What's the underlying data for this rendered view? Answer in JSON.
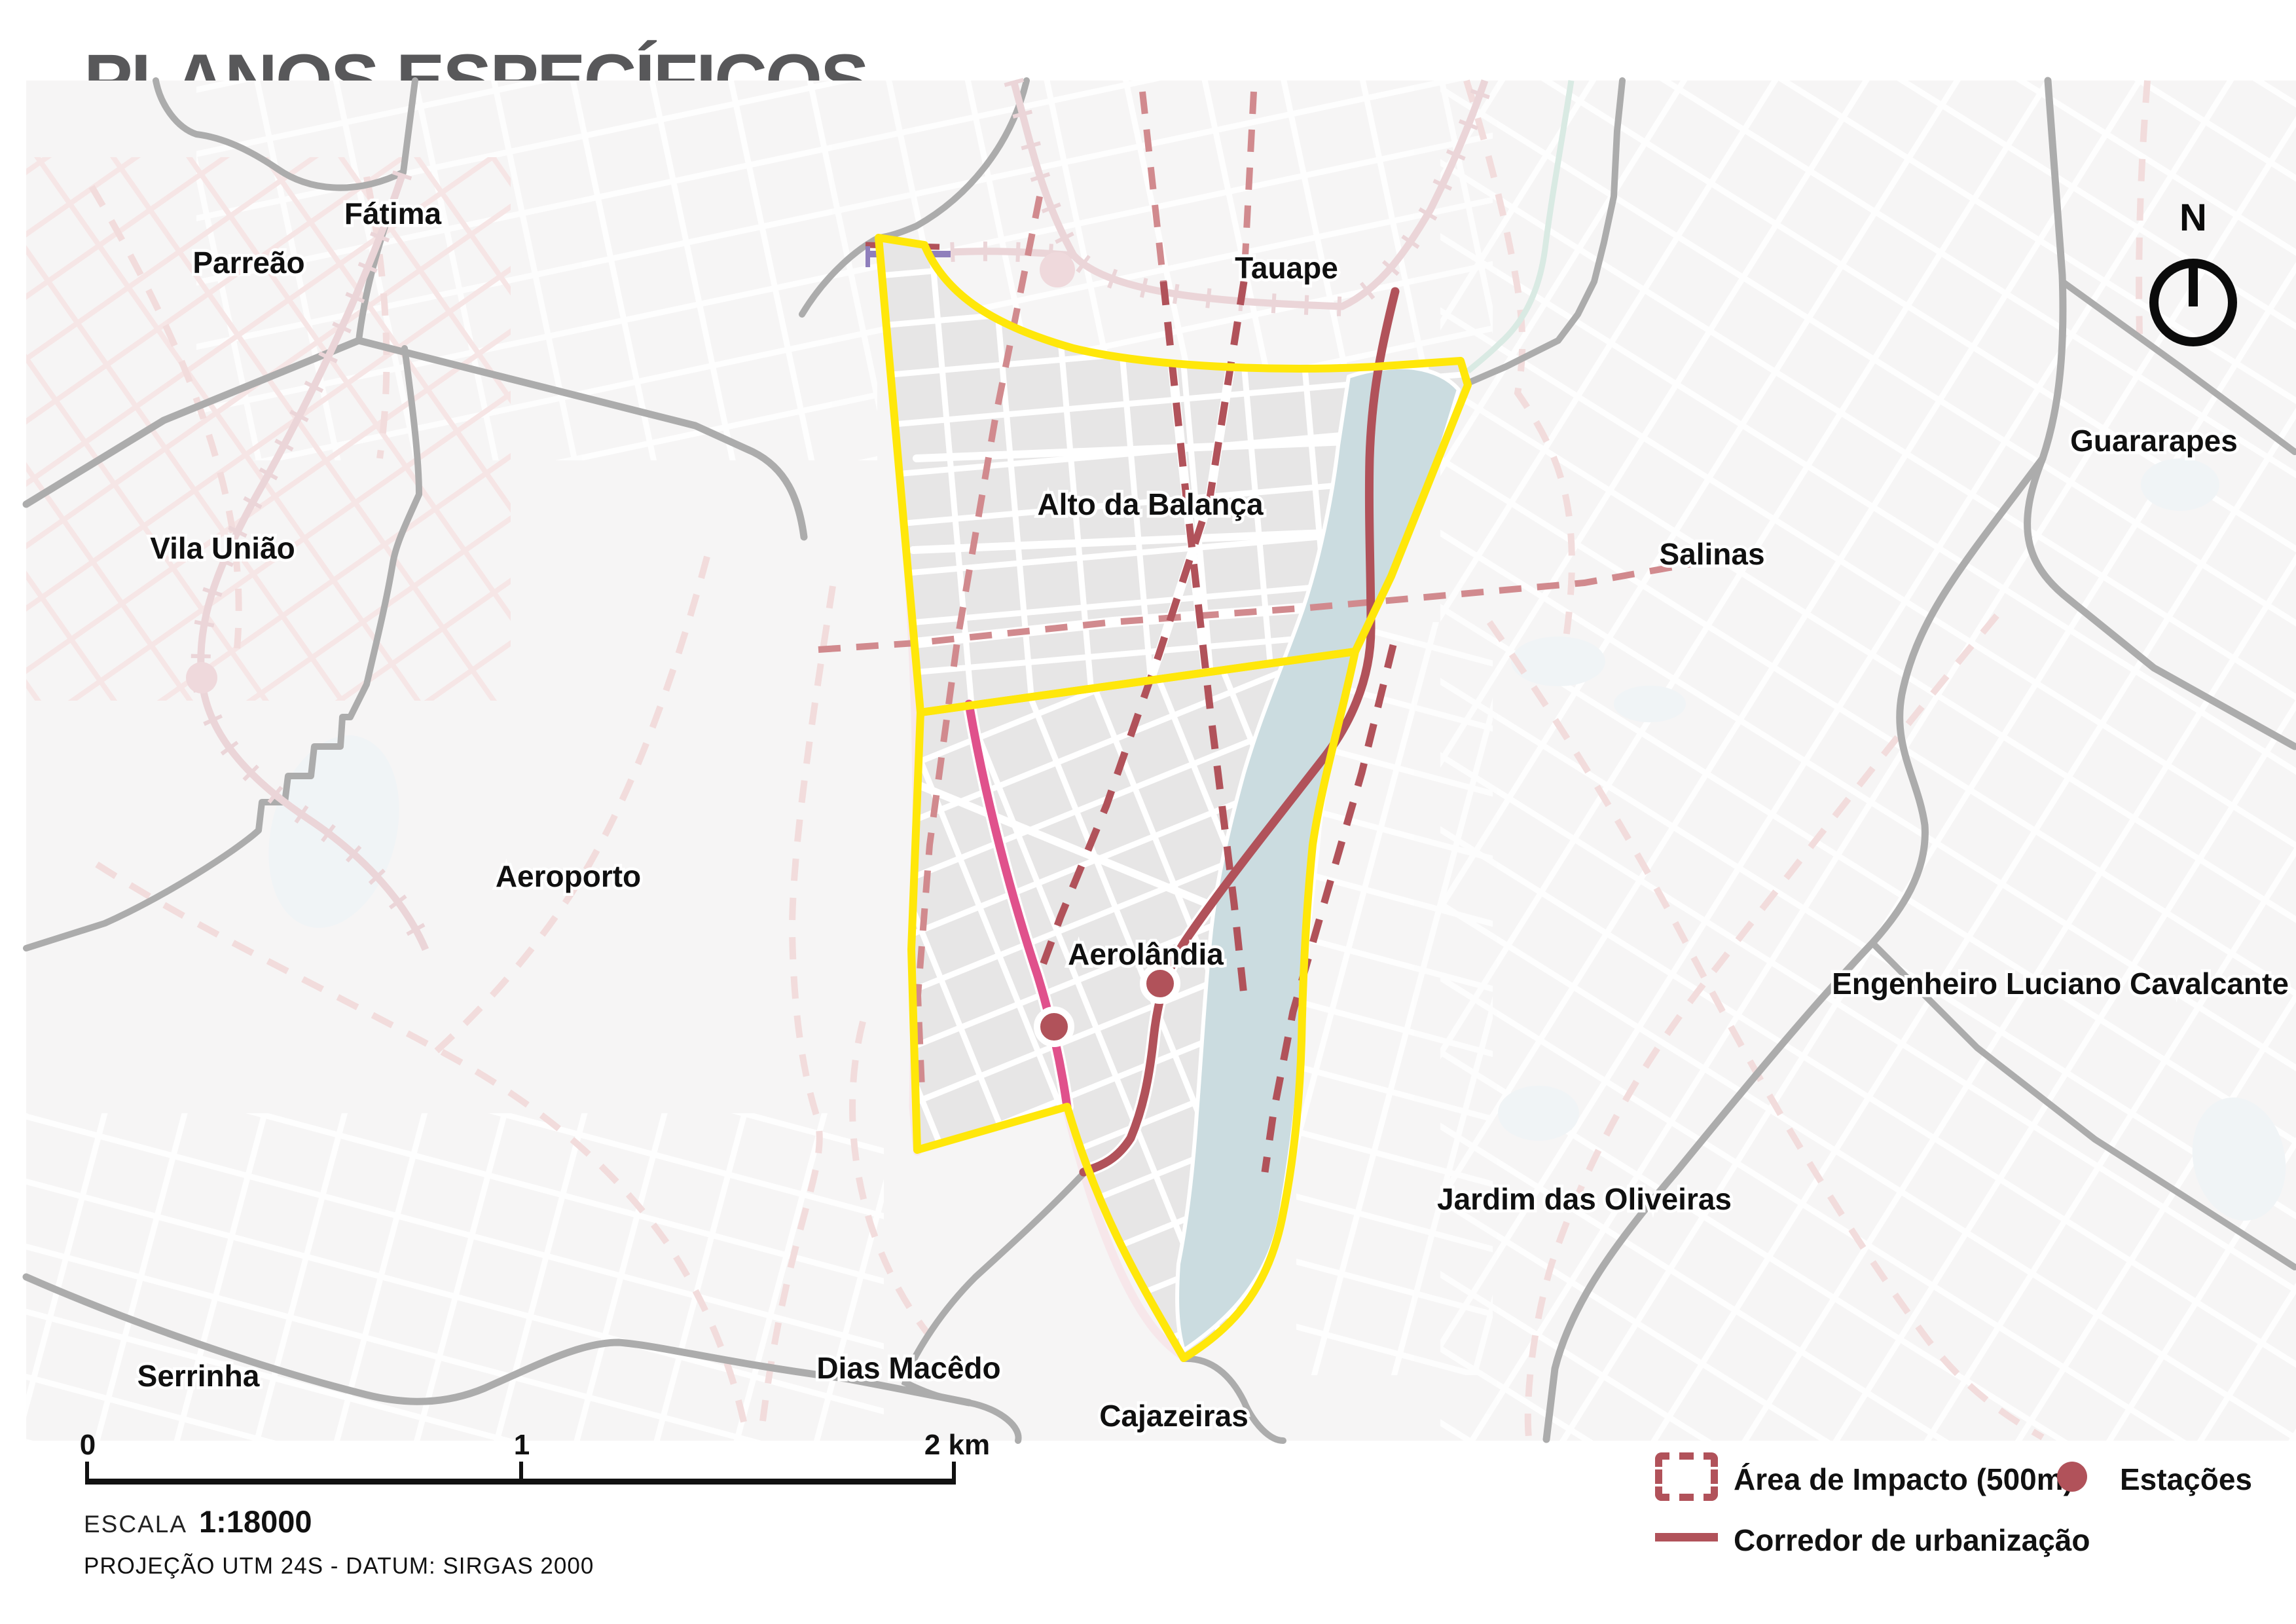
{
  "title": "PLANOS ESPECÍFICOS",
  "brand": {
    "name": "FORTALEZA",
    "year": "2040"
  },
  "north_label": "N",
  "map": {
    "labels": [
      {
        "id": "fatima",
        "name": "Fátima"
      },
      {
        "id": "parreao",
        "name": "Parreão"
      },
      {
        "id": "tauape",
        "name": "Tauape"
      },
      {
        "id": "vila-uniao",
        "name": "Vila União"
      },
      {
        "id": "guararapes",
        "name": "Guararapes"
      },
      {
        "id": "salinas",
        "name": "Salinas"
      },
      {
        "id": "aeroporto",
        "name": "Aeroporto"
      },
      {
        "id": "alto-da-balanca",
        "name": "Alto da Balança"
      },
      {
        "id": "aerolandia",
        "name": "Aerolândia"
      },
      {
        "id": "eng-luciano-cavalcante",
        "name": "Engenheiro Luciano Cavalcante"
      },
      {
        "id": "jardim-das-oliveiras",
        "name": "Jardim das Oliveiras"
      },
      {
        "id": "dias-macedo",
        "name": "Dias Macêdo"
      },
      {
        "id": "serrinha",
        "name": "Serrinha"
      },
      {
        "id": "cajazeiras",
        "name": "Cajazeiras"
      }
    ],
    "stations_count": "2"
  },
  "legend": {
    "impact_label": "Área de Impacto (500m)",
    "stations_label": "Estações",
    "corridor_label": "Corredor de urbanização"
  },
  "scale": {
    "tick0": "0",
    "tick1": "1",
    "tick2": "2 km",
    "escala_label": "ESCALA",
    "escala_value": "1:18000",
    "projection": "PROJEÇÃO UTM 24S - DATUM: SIRGAS 2000"
  },
  "colors": {
    "title": "#58585A",
    "brand": "#7F7F82",
    "bg": "#F6F5F5",
    "blocks": "#E7E6E6",
    "road": "#ACACAC",
    "yellow": "#FFE70A",
    "impact": "#B1525A",
    "impactlight": "#D18A8E",
    "pink": "#E0518C",
    "purple": "#8F7FBC",
    "water": "#CBDCE0",
    "rail": "#EBD5D8",
    "dashfaint": "#F2DCDC",
    "pinkgrid": "#F6E3E3",
    "avenue": "#F7E7EA",
    "teal": "#D9EAE3",
    "pond": "#F0F4F6"
  }
}
